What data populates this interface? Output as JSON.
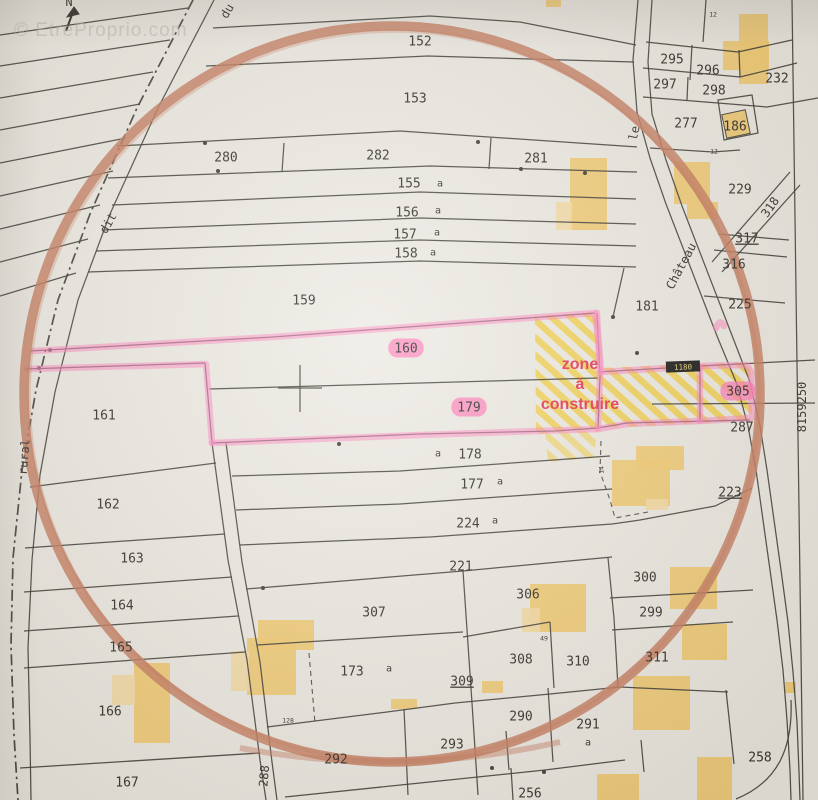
{
  "watermark": "© EtreProprio.com",
  "north_label": "N",
  "sign_box": "1180",
  "annotation": {
    "line1": "zone",
    "line2": "à",
    "line3": "construire"
  },
  "colors": {
    "paper": "#edeae3",
    "ink": "#3c3933",
    "circle_orange": "#c67a5b",
    "parcel_pink": "#ff85bf",
    "label_pink": "#ff79b7",
    "zone_red": "#e6324e",
    "building_yellow": "#f2cb72",
    "building_light": "#f5dca2",
    "hatch_yellow": "#f4cd3a",
    "watermark_gray": "#b9b6ad"
  },
  "labels": {
    "parcels": [
      {
        "t": "152",
        "x": 420,
        "y": 41
      },
      {
        "t": "153",
        "x": 415,
        "y": 98
      },
      {
        "t": "280",
        "x": 226,
        "y": 157
      },
      {
        "t": "282",
        "x": 378,
        "y": 155
      },
      {
        "t": "281",
        "x": 536,
        "y": 158
      },
      {
        "t": "155",
        "x": 409,
        "y": 183
      },
      {
        "t": "156",
        "x": 407,
        "y": 212
      },
      {
        "t": "157",
        "x": 405,
        "y": 234
      },
      {
        "t": "158",
        "x": 406,
        "y": 253
      },
      {
        "t": "159",
        "x": 304,
        "y": 300
      },
      {
        "t": "161",
        "x": 104,
        "y": 415
      },
      {
        "t": "162",
        "x": 108,
        "y": 504
      },
      {
        "t": "163",
        "x": 132,
        "y": 558
      },
      {
        "t": "164",
        "x": 122,
        "y": 605
      },
      {
        "t": "165",
        "x": 121,
        "y": 647
      },
      {
        "t": "166",
        "x": 110,
        "y": 711
      },
      {
        "t": "167",
        "x": 127,
        "y": 782
      },
      {
        "t": "178",
        "x": 470,
        "y": 454
      },
      {
        "t": "177",
        "x": 472,
        "y": 484
      },
      {
        "t": "224",
        "x": 468,
        "y": 523
      },
      {
        "t": "221",
        "x": 461,
        "y": 566
      },
      {
        "t": "307",
        "x": 374,
        "y": 612
      },
      {
        "t": "306",
        "x": 528,
        "y": 594
      },
      {
        "t": "300",
        "x": 645,
        "y": 577
      },
      {
        "t": "299",
        "x": 651,
        "y": 612
      },
      {
        "t": "308",
        "x": 521,
        "y": 659
      },
      {
        "t": "310",
        "x": 578,
        "y": 661
      },
      {
        "t": "311",
        "x": 657,
        "y": 657
      },
      {
        "t": "290",
        "x": 521,
        "y": 716
      },
      {
        "t": "291",
        "x": 588,
        "y": 724
      },
      {
        "t": "293",
        "x": 452,
        "y": 744
      },
      {
        "t": "292",
        "x": 336,
        "y": 759
      },
      {
        "t": "256",
        "x": 530,
        "y": 793
      },
      {
        "t": "258",
        "x": 760,
        "y": 757
      },
      {
        "t": "173",
        "x": 352,
        "y": 671
      },
      {
        "t": "287",
        "x": 742,
        "y": 427
      },
      {
        "t": "225",
        "x": 740,
        "y": 304
      },
      {
        "t": "316",
        "x": 734,
        "y": 264
      },
      {
        "t": "181",
        "x": 647,
        "y": 306
      },
      {
        "t": "229",
        "x": 740,
        "y": 189
      },
      {
        "t": "277",
        "x": 686,
        "y": 123
      },
      {
        "t": "186",
        "x": 735,
        "y": 126
      },
      {
        "t": "295",
        "x": 672,
        "y": 59
      },
      {
        "t": "296",
        "x": 708,
        "y": 70
      },
      {
        "t": "297",
        "x": 665,
        "y": 84
      },
      {
        "t": "298",
        "x": 714,
        "y": 90
      },
      {
        "t": "232",
        "x": 777,
        "y": 78
      }
    ],
    "underlined": [
      {
        "t": "317",
        "x": 747,
        "y": 238
      },
      {
        "t": "223",
        "x": 730,
        "y": 492
      },
      {
        "t": "309",
        "x": 462,
        "y": 681
      }
    ],
    "highlighted": [
      {
        "t": "160",
        "x": 406,
        "y": 348
      },
      {
        "t": "179",
        "x": 469,
        "y": 407
      },
      {
        "t": "305",
        "x": 738,
        "y": 391
      }
    ],
    "letters": [
      {
        "t": "a",
        "x": 440,
        "y": 183
      },
      {
        "t": "a",
        "x": 438,
        "y": 210
      },
      {
        "t": "a",
        "x": 437,
        "y": 232
      },
      {
        "t": "a",
        "x": 433,
        "y": 252
      },
      {
        "t": "a",
        "x": 438,
        "y": 453
      },
      {
        "t": "a",
        "x": 500,
        "y": 481
      },
      {
        "t": "a",
        "x": 495,
        "y": 520
      },
      {
        "t": "a",
        "x": 389,
        "y": 668
      },
      {
        "t": "a",
        "x": 588,
        "y": 742
      }
    ],
    "tiny": [
      {
        "t": "12",
        "x": 714,
        "y": 151,
        "r": 0
      },
      {
        "t": "14",
        "x": 601,
        "y": 470,
        "r": -90
      },
      {
        "t": "128",
        "x": 288,
        "y": 720,
        "r": 0
      },
      {
        "t": "49",
        "x": 544,
        "y": 638,
        "r": 0
      },
      {
        "t": "12",
        "x": 713,
        "y": 14,
        "r": 0
      }
    ],
    "rotated": [
      {
        "t": "du",
        "x": 227,
        "y": 11,
        "r": -60
      },
      {
        "t": "dit",
        "x": 108,
        "y": 223,
        "r": -60
      },
      {
        "t": "rural",
        "x": 24,
        "y": 457,
        "r": -85
      },
      {
        "t": "le",
        "x": 634,
        "y": 133,
        "r": -78
      },
      {
        "t": "Château",
        "x": 681,
        "y": 266,
        "r": -62
      },
      {
        "t": "318",
        "x": 770,
        "y": 207,
        "r": -55
      },
      {
        "t": "288",
        "x": 264,
        "y": 776,
        "r": -85
      },
      {
        "t": "8159250",
        "x": 802,
        "y": 407,
        "r": -90
      }
    ]
  }
}
